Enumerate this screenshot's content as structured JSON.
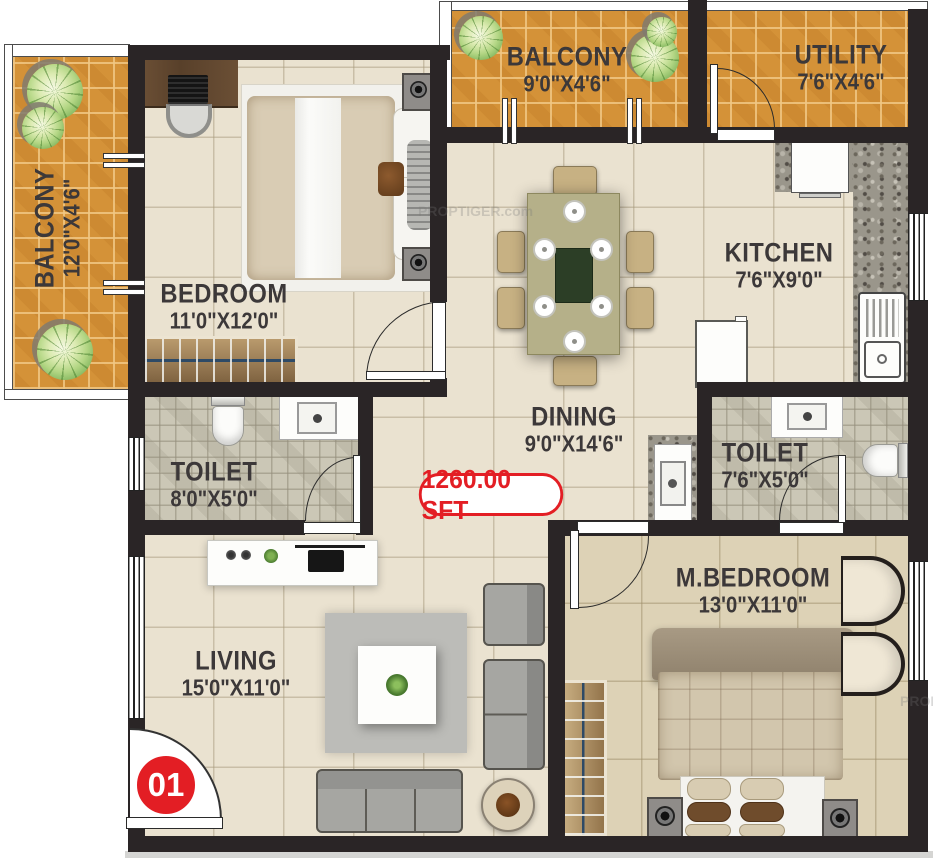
{
  "title": "2BHK Floor Plan",
  "area_badge": "1260.00 SFT",
  "unit_number": "01",
  "watermark": "PROPTIGER.com",
  "colors": {
    "wall": "#2a2526",
    "floor_beige": "#eae2d0",
    "floor_tan": "#ddd2b6",
    "balcony_tile": "#d49238",
    "toilet_tile": "#cbc7b6",
    "granite": "#9a968b",
    "accent_red": "#e31e24",
    "label_text": "#3c3839"
  },
  "rooms": {
    "balcony_left": {
      "name": "BALCONY",
      "dims": "12'0\"X4'6\""
    },
    "bedroom": {
      "name": "BEDROOM",
      "dims": "11'0\"X12'0\""
    },
    "balcony_top": {
      "name": "BALCONY",
      "dims": "9'0\"X4'6\""
    },
    "utility": {
      "name": "UTILITY",
      "dims": "7'6\"X4'6\""
    },
    "kitchen": {
      "name": "KITCHEN",
      "dims": "7'6\"X9'0\""
    },
    "dining": {
      "name": "DINING",
      "dims": "9'0\"X14'6\""
    },
    "toilet_left": {
      "name": "TOILET",
      "dims": "8'0\"X5'0\""
    },
    "toilet_right": {
      "name": "TOILET",
      "dims": "7'6\"X5'0\""
    },
    "living": {
      "name": "LIVING",
      "dims": "15'0\"X11'0\""
    },
    "m_bedroom": {
      "name": "M.BEDROOM",
      "dims": "13'0\"X11'0\""
    }
  }
}
